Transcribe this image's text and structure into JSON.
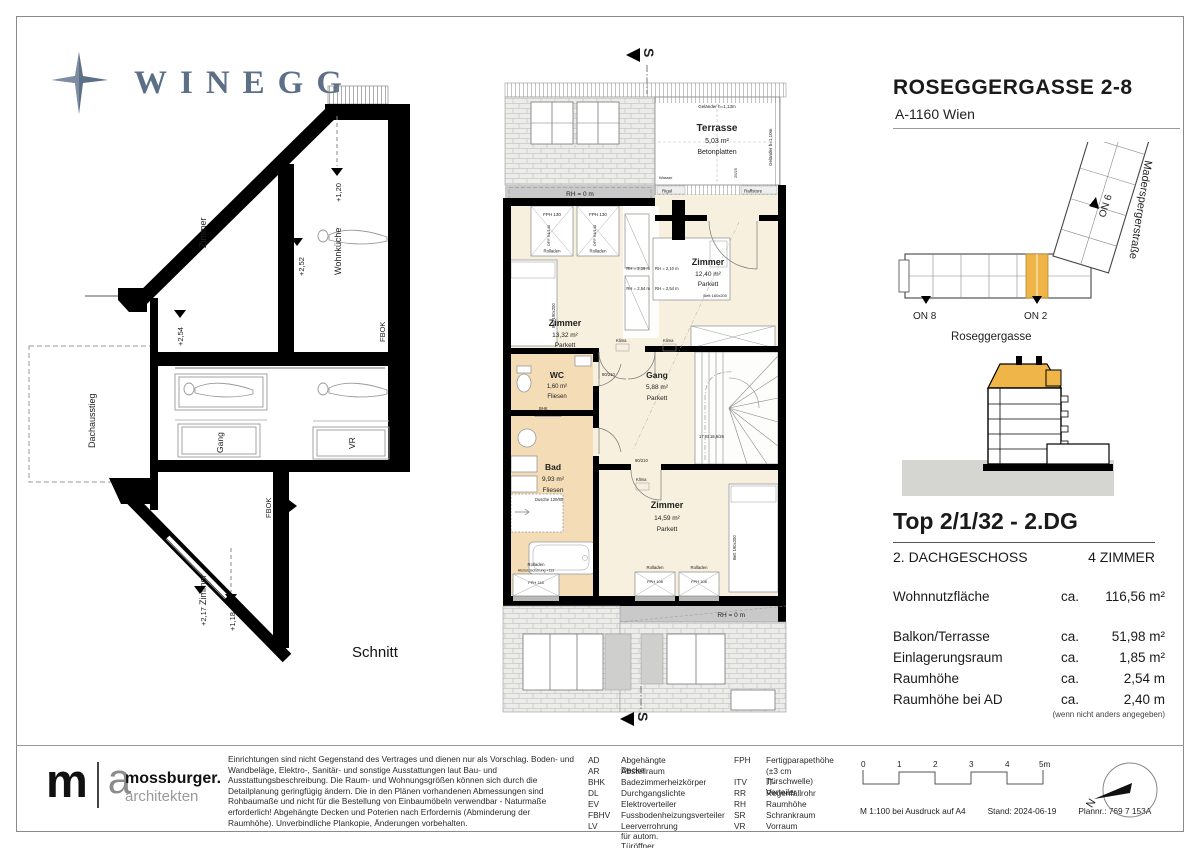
{
  "brand": {
    "name": "WINEGG"
  },
  "project": {
    "title": "ROSEGGERGASSE 2-8",
    "city": "A-1160 Wien"
  },
  "site": {
    "on8": "ON 8",
    "on2": "ON 2",
    "on6": "ON 6",
    "street_v": "Maderspergerstraße",
    "street_h": "Roseggergasse"
  },
  "unit": {
    "title": "Top 2/1/32 - 2.DG",
    "floor": "2. DACHGESCHOSS",
    "rooms": "4 ZIMMER",
    "area_label": "Wohnnutzfläche",
    "area_ca": "ca.",
    "area_value": "116,56 m²",
    "rows": [
      {
        "label": "Balkon/Terrasse",
        "ca": "ca.",
        "value": "51,98 m²"
      },
      {
        "label": "Einlagerungsraum",
        "ca": "ca.",
        "value": "1,85 m²"
      },
      {
        "label": "Raumhöhe",
        "ca": "ca.",
        "value": "2,54 m"
      },
      {
        "label": "Raumhöhe bei AD",
        "ca": "ca.",
        "value": "2,40 m"
      }
    ],
    "note": "(wenn nicht anders angegeben)"
  },
  "schnitt": {
    "label": "Schnitt",
    "rooms": {
      "zimmer_top": "Zimmer",
      "wohnkueche": "Wohnküche",
      "gang": "Gang",
      "vr": "VR",
      "zimmer_bottom": "Zimmer",
      "dachausstieg": "Dachausstieg"
    },
    "levels": {
      "l254": "+2,54",
      "l252": "+2,52",
      "l120": "+1,20",
      "l217": "+2,17",
      "l118": "+1,18",
      "fbok": "FBOK"
    }
  },
  "plan": {
    "section_marker": "S",
    "terrace": {
      "name": "Terrasse",
      "area": "5,03 m²",
      "floor": "Betonplatten",
      "railing_top": "Geländer h=1,13m",
      "railing_right": "Geländer h=1,10m",
      "water": "Wasser",
      "drain": "Rigol",
      "blind": "Raffstore",
      "grid": "25/25"
    },
    "entry": {
      "step": "Stufe h=17cm",
      "fph": "FPH 17",
      "dl": "DL 90"
    },
    "bands": {
      "rh0": "RH = 0 m",
      "rh032": "RH = 0,32 m"
    },
    "rooms": {
      "z1": {
        "name": "Zimmer",
        "area": "13,32 m²",
        "floor": "Parkett"
      },
      "z2": {
        "name": "Zimmer",
        "area": "12,40 m²",
        "floor": "Parkett"
      },
      "wc": {
        "name": "WC",
        "area": "1,60 m²",
        "floor": "Fliesen"
      },
      "gang": {
        "name": "Gang",
        "area": "5,88 m²",
        "floor": "Parkett"
      },
      "bad": {
        "name": "Bad",
        "area": "9,93 m²",
        "floor": "Fliesen"
      },
      "z3": {
        "name": "Zimmer",
        "area": "14,59 m²",
        "floor": "Parkett"
      }
    },
    "annotations": {
      "fph130": "FPH 130",
      "rolladen": "Rolladen",
      "dff": "DFF 94/140",
      "rh216": "RH = 2,16 m",
      "rh254": "RH = 2,54 m",
      "rh210": "RH = 2,10 m",
      "bett160": "Bett 160x200",
      "bett190": "Bett 190x200",
      "klima": "Klima",
      "bhk": "BHK",
      "stairs": "17 St 18,6/26",
      "dusche": "Dusche 120/80",
      "absturz": "Absturzsicherung +113",
      "fph118": "FPH 118",
      "fph108": "FPH 108",
      "door80": "80/210",
      "door90": "90/210"
    }
  },
  "footer": {
    "logo_m": "m",
    "logo_a": "a",
    "firm": "mossburger.",
    "firm2": "architekten",
    "disclaimer": "Einrichtungen sind nicht Gegenstand des Vertrages und dienen nur als Vorschlag. Boden- und Wandbeläge, Elektro-, Sanitär- und sonstige Ausstattungen laut Bau- und Ausstattungsbeschreibung. Die Raum- und Wohnungsgrößen können sich durch die Detailplanung geringfügig ändern. Die in den Plänen vorhandenen Abmessungen sind Rohbaumaße und nicht für die Bestellung von Einbaumöbeln verwendbar - Naturmaße erforderlich! Abgehängte Decken und Poterien nach Erfordernis (Abminderung der Raumhöhe). Unverbindliche Plankopie, Änderungen vorbehalten.",
    "legend1": [
      [
        "AD",
        "Abgehängte Decke"
      ],
      [
        "AR",
        "Abstellraum"
      ],
      [
        "BHK",
        "Badezimmerheizkörper"
      ],
      [
        "DL",
        "Durchgangslichte"
      ],
      [
        "EV",
        "Elektroverteiler"
      ],
      [
        "FBHV",
        "Fussbodenheizungsverteiler"
      ],
      [
        "LV",
        "Leerverrohrung für autom. Türöffner"
      ]
    ],
    "legend2": [
      [
        "FPH",
        "Fertigparapethöhe"
      ],
      [
        "",
        "(±3 cm Türschwelle)"
      ],
      [
        "ITV",
        "IT- Verteiler"
      ],
      [
        "RR",
        "Regenfallrohr"
      ],
      [
        "RH",
        "Raumhöhe"
      ],
      [
        "SR",
        "Schrankraum"
      ],
      [
        "VR",
        "Vorraum"
      ]
    ],
    "scale": [
      "0",
      "1",
      "2",
      "3",
      "4",
      "5m"
    ],
    "print": "M 1:100 bei Ausdruck auf A4",
    "stand": "Stand: 2024-06-19",
    "plannr": "Plannr.: 769 7 153A",
    "north": "N"
  }
}
